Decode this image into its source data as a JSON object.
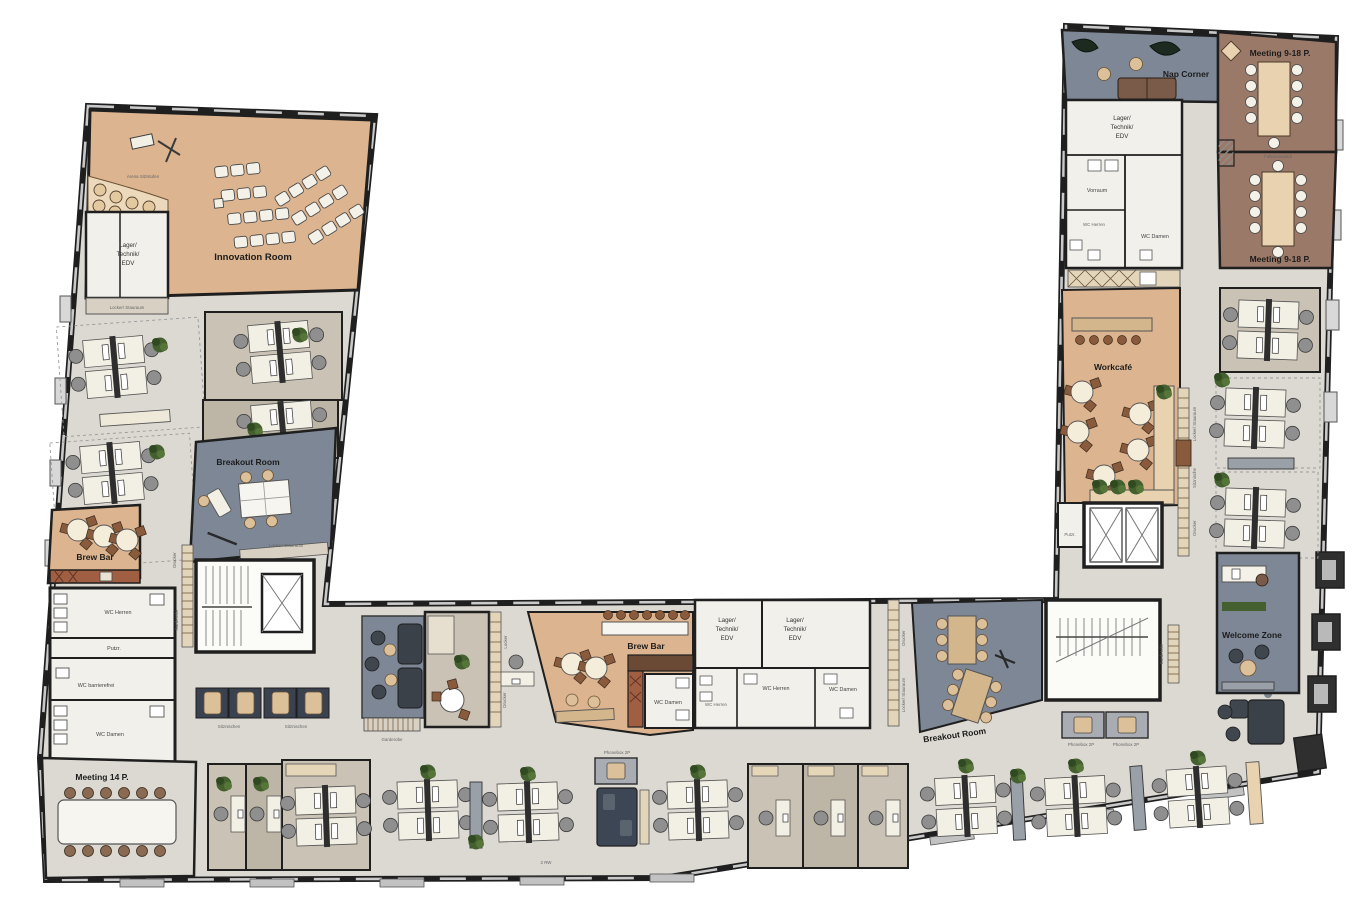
{
  "plan_title": "Office floor plan",
  "rooms": {
    "innovation_room": "Innovation Room",
    "arena": "Arena Sitzstufen",
    "lager_l1": "Lager/",
    "lager_l2": "Technik/",
    "lager_l3": "EDV",
    "locker_stauraum": "Locker/ Stauraum",
    "breakout_room": "Breakout Room",
    "brew_bar": "Brew Bar",
    "wc_herren": "WC Herren",
    "wc_damen": "WC Damen",
    "wc_barrierefrei": "WC barrierefrei",
    "putzraum": "Putzr.",
    "meeting_14": "Meeting 14 P.",
    "sitznischen": "Sitznischen",
    "sitznische": "Sitznische",
    "drucker": "Drucker",
    "garderobe": "Garderobe",
    "locker": "Locker",
    "phonebox_2p": "Phonebox 2P",
    "nap_corner": "Nap Corner",
    "meeting_9_18": "Meeting 9-18 P.",
    "falttrennwand": "Falttrennwand",
    "vorraum": "Vorraum",
    "workcafe": "Workcafé",
    "welcome_zone": "Welcome Zone",
    "annotation_small": "2 RW"
  },
  "colors": {
    "floor": "#dcd9d2",
    "carpet": "#cac3b5",
    "carpet_dark": "#bdb5a6",
    "tan": "#dcb48f",
    "tan_light": "#e8d2b0",
    "gray_blue": "#7d8795",
    "brown_room": "#9b7968",
    "rust": "#a05f43",
    "kitchen_dark": "#6b4a35",
    "white_room": "#f2f0ea",
    "wall": "#1f1f1f",
    "wood": "#d3b68c",
    "sofa": "#3a4149",
    "plant": "#44602f",
    "chair_gray": "#8f8f8f",
    "chair_tan": "#d9b98c"
  }
}
